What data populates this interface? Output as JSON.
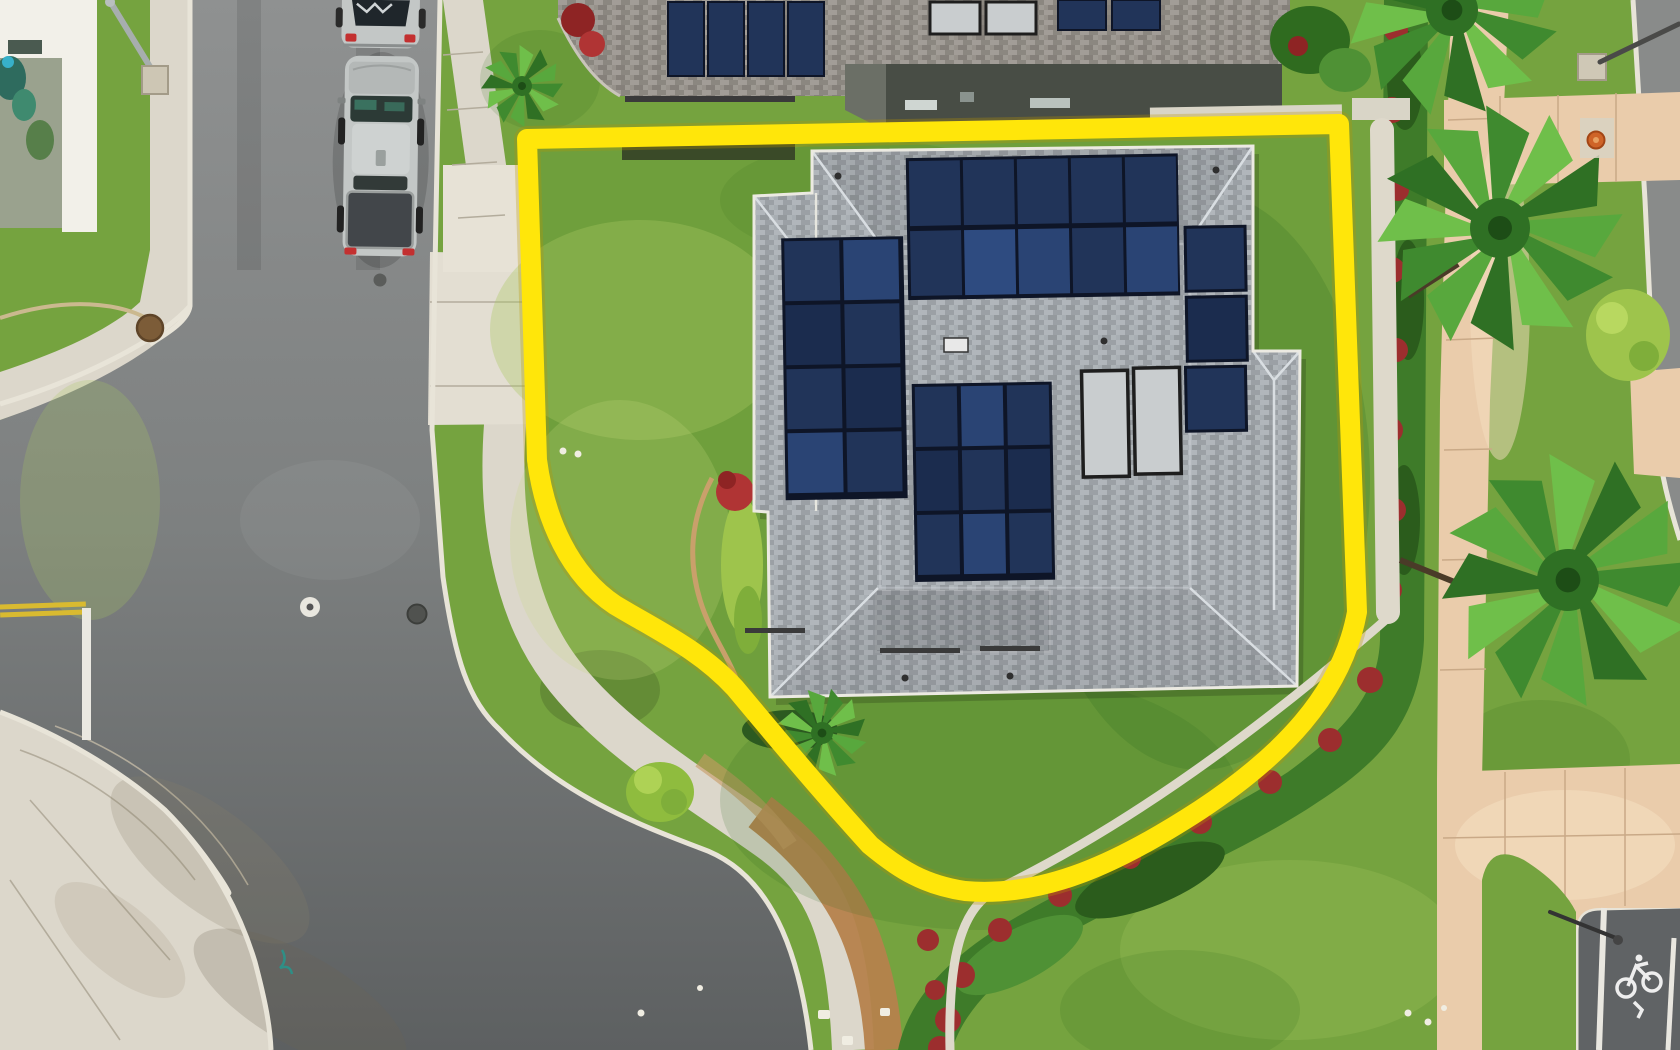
{
  "meta": {
    "image_type": "aerial-drone-photo",
    "description": "Overhead drone view of a corner-lot single family home with rooftop solar, outlined by a yellow property boundary overlay",
    "canvas": {
      "width": 1680,
      "height": 1050
    }
  },
  "colors": {
    "asphalt_light": "#8f9191",
    "asphalt_mid": "#7d8080",
    "asphalt_dark": "#5d6061",
    "asphalt_right": "#898b8a",
    "concrete": "#dcd7cb",
    "concrete_bright": "#eae5d9",
    "curb_white": "#e8e4d8",
    "sidewalk_pink": "#eaccab",
    "grass_base": "#75a33f",
    "lawn_subject": "#6f9f3c",
    "grass_dark": "#2f6b1f",
    "grass_light": "#a9c861",
    "roof_shingle": "#a8aeb3",
    "roof_neighbor": "#97928b",
    "roof_lanai": "#484d45",
    "panel_navy": "#213459",
    "panel_frame": "#0e1527",
    "water_heater": "#c9cdcf",
    "boundary_yellow": "#ffe60a",
    "hedge_green": "#3e7b29",
    "hedge_red": "#9c2e2e",
    "dirt_path": "#b5824c",
    "palm_green": "#4f9a35",
    "white_building": "#f2f0e9",
    "vehicle_silver": "#c3c7c6",
    "truck_bed": "#42464a",
    "taillight_red": "#c33030",
    "marking_white": "#eae8e1",
    "marking_yellow": "#d9ba30",
    "wall_white": "#ded9cb",
    "hydrant_orange": "#cf6428"
  },
  "scene": {
    "subject_property": {
      "boundary": "yellow property-line overlay",
      "house": {
        "roof": "gray asphalt shingle hip roof",
        "solar_panel_count": 30,
        "solar_water_heater_count": 2,
        "skylight_count": 1
      },
      "driveway": "concrete driveway to west street",
      "landscaping": [
        "front lawn",
        "back lawn",
        "chartreuse hedge",
        "red ti shrubs",
        "small palm"
      ]
    },
    "neighbor_north_house": {
      "solar_panel_count": 8,
      "solar_water_heater_count": 2,
      "lanai_roof": "dark flat patio cover"
    },
    "vehicles": [
      {
        "type": "sedan",
        "color": "silver"
      },
      {
        "type": "pickup-truck",
        "color": "silver cab, dark tonneau bed"
      }
    ],
    "road_markings": [
      "double yellow centerline",
      "white stop bar",
      "white survey circle",
      "bike-lane stencil",
      "bike-lane edge lines"
    ],
    "vegetation": {
      "fan_palm_count": 3,
      "parkway_bush_count": 1,
      "boundary_hedge": "green groundcover with red accents"
    },
    "street_furniture": [
      "streetlight pole top-left",
      "streetlight pole top-right",
      "fire hydrant",
      "streetlight arm bottom-right",
      "manhole covers"
    ]
  }
}
